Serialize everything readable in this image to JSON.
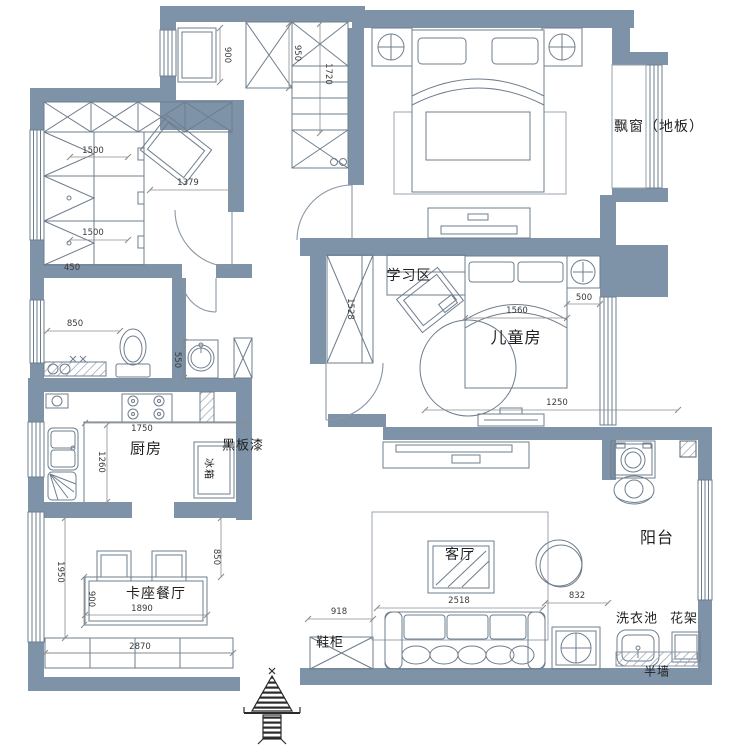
{
  "floorplan": {
    "colors": {
      "wall": "#7E92A8",
      "furniture_line": "#6E7D8D",
      "light_line": "#93A0AD",
      "dim_line": "#8C8C8C",
      "dim_text": "#3A3A3A",
      "label_text": "#1F1F1F"
    },
    "room_labels": [
      {
        "id": "bay-window-floor",
        "text": "飘窗（地板）",
        "x": 659,
        "y": 126,
        "size": 14,
        "rot": 0
      },
      {
        "id": "study-area",
        "text": "学习区",
        "x": 409,
        "y": 275,
        "size": 14,
        "rot": 0
      },
      {
        "id": "kids-room",
        "text": "儿童房",
        "x": 516,
        "y": 336,
        "size": 16,
        "rot": 0
      },
      {
        "id": "kitchen",
        "text": "厨房",
        "x": 146,
        "y": 448,
        "size": 15,
        "rot": 0
      },
      {
        "id": "blackboard-paint",
        "text": "黑板漆",
        "x": 243,
        "y": 444,
        "size": 13,
        "rot": 0
      },
      {
        "id": "fridge",
        "text": "冰箱",
        "x": 210,
        "y": 469,
        "size": 10,
        "rot": 90
      },
      {
        "id": "booth-dining",
        "text": "卡座餐厅",
        "x": 156,
        "y": 593,
        "size": 14,
        "rot": 0
      },
      {
        "id": "living-room",
        "text": "客厅",
        "x": 460,
        "y": 554,
        "size": 14,
        "rot": 0
      },
      {
        "id": "balcony",
        "text": "阳台",
        "x": 657,
        "y": 536,
        "size": 16,
        "rot": 0
      },
      {
        "id": "shoe-cabinet",
        "text": "鞋柜",
        "x": 330,
        "y": 641,
        "size": 13,
        "rot": 0
      },
      {
        "id": "laundry-sink",
        "text": "洗衣池",
        "x": 637,
        "y": 617,
        "size": 13,
        "rot": 0
      },
      {
        "id": "flower-rack",
        "text": "花架",
        "x": 684,
        "y": 617,
        "size": 13,
        "rot": 0
      },
      {
        "id": "half-wall",
        "text": "半墙",
        "x": 657,
        "y": 671,
        "size": 12,
        "rot": 0
      }
    ],
    "dimensions": [
      {
        "text": "900",
        "x": 227,
        "y": 55,
        "rot": 90,
        "line": [
          220,
          28,
          220,
          82
        ]
      },
      {
        "text": "950",
        "x": 297,
        "y": 53,
        "rot": 90,
        "line": [
          289,
          24,
          289,
          88
        ]
      },
      {
        "text": "1720",
        "x": 328,
        "y": 74,
        "rot": 90,
        "line": [
          320,
          24,
          320,
          133
        ]
      },
      {
        "text": "1500",
        "x": 93,
        "y": 151,
        "rot": 0,
        "line": [
          70,
          157,
          128,
          157
        ]
      },
      {
        "text": "1379",
        "x": 188,
        "y": 183,
        "rot": 0,
        "line": [
          150,
          190,
          233,
          190
        ]
      },
      {
        "text": "1500",
        "x": 93,
        "y": 233,
        "rot": 0,
        "line": [
          70,
          240,
          128,
          240
        ]
      },
      {
        "text": "450",
        "x": 72,
        "y": 268,
        "rot": 0,
        "line": null
      },
      {
        "text": "850",
        "x": 75,
        "y": 324,
        "rot": 0,
        "line": [
          47,
          331,
          120,
          331
        ]
      },
      {
        "text": "550",
        "x": 177,
        "y": 360,
        "rot": 90,
        "line": [
          184,
          342,
          184,
          378
        ]
      },
      {
        "text": "1528",
        "x": 350,
        "y": 309,
        "rot": 90,
        "line": null
      },
      {
        "text": "1560",
        "x": 517,
        "y": 311,
        "rot": 0,
        "line": [
          465,
          318,
          567,
          318
        ]
      },
      {
        "text": "500",
        "x": 584,
        "y": 298,
        "rot": 0,
        "line": [
          567,
          304,
          600,
          304
        ]
      },
      {
        "text": "1250",
        "x": 557,
        "y": 403,
        "rot": 0,
        "line": [
          425,
          410,
          678,
          410
        ]
      },
      {
        "text": "1750",
        "x": 142,
        "y": 429,
        "rot": 0,
        "line": [
          85,
          423,
          246,
          423
        ]
      },
      {
        "text": "1260",
        "x": 101,
        "y": 462,
        "rot": 90,
        "line": [
          107,
          425,
          107,
          502
        ]
      },
      {
        "text": "850",
        "x": 216,
        "y": 557,
        "rot": 90,
        "line": [
          221,
          518,
          221,
          577
        ]
      },
      {
        "text": "1950",
        "x": 60,
        "y": 572,
        "rot": 90,
        "line": [
          65,
          518,
          65,
          638
        ]
      },
      {
        "text": "900",
        "x": 91,
        "y": 599,
        "rot": 90,
        "line": [
          84,
          577,
          84,
          625
        ]
      },
      {
        "text": "1890",
        "x": 142,
        "y": 609,
        "rot": 0,
        "line": [
          85,
          615,
          207,
          615
        ]
      },
      {
        "text": "2870",
        "x": 140,
        "y": 647,
        "rot": 0,
        "line": [
          45,
          653,
          233,
          653
        ]
      },
      {
        "text": "918",
        "x": 339,
        "y": 612,
        "rot": 0,
        "line": [
          308,
          619,
          373,
          619
        ]
      },
      {
        "text": "2518",
        "x": 459,
        "y": 601,
        "rot": 0,
        "line": [
          377,
          608,
          543,
          608
        ]
      },
      {
        "text": "832",
        "x": 577,
        "y": 596,
        "rot": 0,
        "line": [
          545,
          603,
          608,
          603
        ]
      }
    ]
  }
}
